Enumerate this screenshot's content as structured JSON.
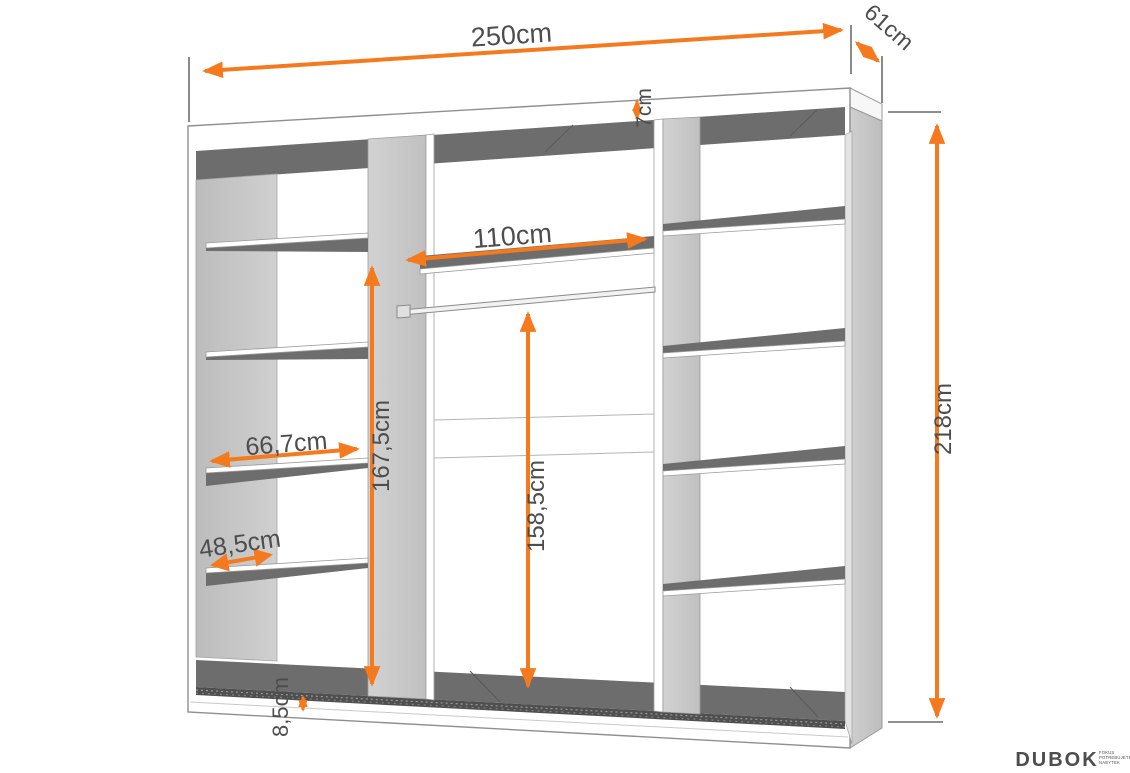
{
  "diagram": {
    "title": "wardrobe interior dimension drawing",
    "labels": {
      "width_total": "250cm",
      "depth": "61cm",
      "top_panel": "7cm",
      "height_total": "218cm",
      "middle_width": "110cm",
      "inner_height": "167,5cm",
      "rod_height": "158,5cm",
      "shelf_width": "66,7cm",
      "shelf_depth": "48,5cm",
      "plinth_height": "8,5cm"
    },
    "colors": {
      "dimension_accent": "#F57A1D",
      "panel_dark": "#6d6d6d",
      "panel_gray": "#c6c6c6",
      "outline": "#8f8f8f",
      "label_text": "#4d4d4d",
      "logo_green": "#8fe8af"
    }
  },
  "logo": {
    "name": "DUBOK",
    "tagline1": "FOKUS",
    "tagline2": "POTREBUJETE",
    "tagline3": "NABYTEK"
  }
}
